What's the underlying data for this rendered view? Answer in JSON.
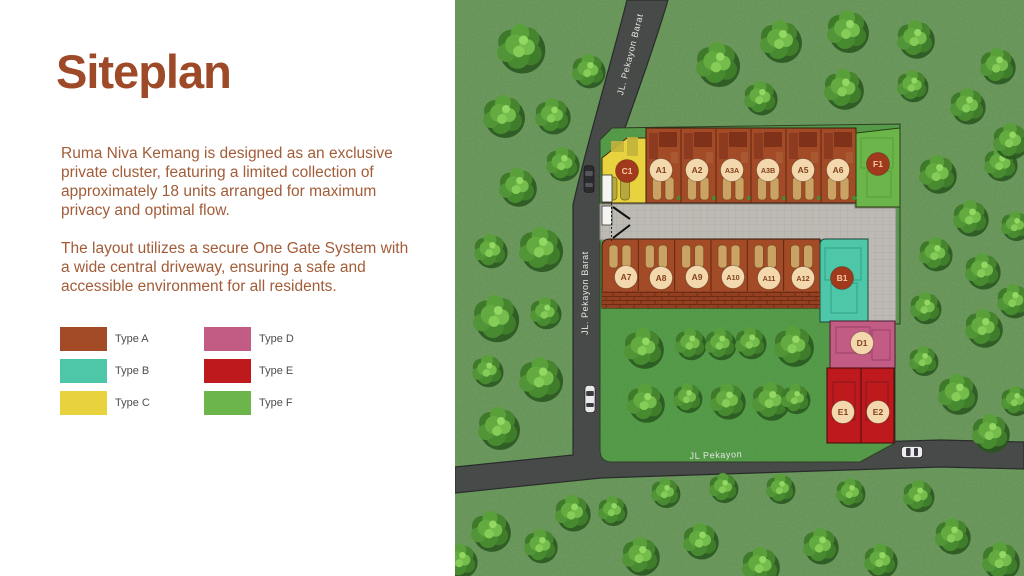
{
  "slide": {
    "title": "Siteplan",
    "paragraphs": [
      "Ruma Niva Kemang is designed as an exclusive private cluster, featuring a limited collection of approximately 18 units arranged for maximum privacy and optimal flow.",
      "The layout utilizes a secure One Gate System with a wide central driveway, ensuring a safe and accessible environment for all residents."
    ]
  },
  "legend": {
    "items": [
      {
        "label": "Type A",
        "color": "#a34a26"
      },
      {
        "label": "Type B",
        "color": "#4ec7a8"
      },
      {
        "label": "Type C",
        "color": "#e8d33f"
      },
      {
        "label": "Type D",
        "color": "#c25c84"
      },
      {
        "label": "Type E",
        "color": "#be1a1e"
      },
      {
        "label": "Type F",
        "color": "#6cb54a"
      }
    ]
  },
  "map": {
    "colors": {
      "grass_outer": "#6f9d61",
      "grass_inner": "#57a14c",
      "road": "#48484b",
      "driveway": "#bdbab4",
      "title_text": "#9e4a28",
      "body_text": "#a35c38",
      "road_label_text": "#e6e6e2"
    },
    "road_labels": [
      {
        "text": "JL. Pekayon Barat",
        "x": 633,
        "y": 55,
        "rotate": -76
      },
      {
        "text": "JL. Pekayon Barat",
        "x": 588,
        "y": 293,
        "rotate": -90
      },
      {
        "text": "JL Pekayon",
        "x": 716,
        "y": 458,
        "rotate": -2
      }
    ],
    "unit_marker_styles": {
      "light": {
        "bg": "#f2d8ac",
        "fg": "#82401e"
      },
      "dark": {
        "bg": "#a13a1c",
        "fg": "#f9c9a2"
      }
    },
    "units": [
      {
        "id": "C1",
        "x": 627,
        "y": 171,
        "style": "dark"
      },
      {
        "id": "A1",
        "x": 661,
        "y": 170,
        "style": "light"
      },
      {
        "id": "A2",
        "x": 697,
        "y": 170,
        "style": "light"
      },
      {
        "id": "A3A",
        "x": 732,
        "y": 170,
        "style": "light"
      },
      {
        "id": "A3B",
        "x": 768,
        "y": 170,
        "style": "light"
      },
      {
        "id": "A5",
        "x": 803,
        "y": 170,
        "style": "light"
      },
      {
        "id": "A6",
        "x": 838,
        "y": 170,
        "style": "light"
      },
      {
        "id": "F1",
        "x": 878,
        "y": 164,
        "style": "dark"
      },
      {
        "id": "A7",
        "x": 626,
        "y": 277,
        "style": "light"
      },
      {
        "id": "A8",
        "x": 661,
        "y": 278,
        "style": "light"
      },
      {
        "id": "A9",
        "x": 697,
        "y": 277,
        "style": "light"
      },
      {
        "id": "A10",
        "x": 733,
        "y": 277,
        "style": "light"
      },
      {
        "id": "A11",
        "x": 769,
        "y": 278,
        "style": "light"
      },
      {
        "id": "A12",
        "x": 803,
        "y": 278,
        "style": "light"
      },
      {
        "id": "B1",
        "x": 842,
        "y": 278,
        "style": "dark"
      },
      {
        "id": "D1",
        "x": 862,
        "y": 343,
        "style": "light"
      },
      {
        "id": "E1",
        "x": 843,
        "y": 412,
        "style": "light"
      },
      {
        "id": "E2",
        "x": 878,
        "y": 412,
        "style": "light"
      }
    ],
    "trees": [
      [
        520,
        47,
        1.15
      ],
      [
        588,
        70,
        0.8
      ],
      [
        503,
        115,
        1.0
      ],
      [
        552,
        115,
        0.85
      ],
      [
        562,
        163,
        0.8
      ],
      [
        517,
        186,
        0.9
      ],
      [
        490,
        250,
        0.8
      ],
      [
        540,
        248,
        1.05
      ],
      [
        495,
        317,
        1.1
      ],
      [
        545,
        312,
        0.75
      ],
      [
        487,
        370,
        0.75
      ],
      [
        540,
        378,
        1.05
      ],
      [
        498,
        427,
        1.0
      ],
      [
        717,
        63,
        1.05
      ],
      [
        780,
        40,
        1.0
      ],
      [
        760,
        97,
        0.8
      ],
      [
        847,
        30,
        1.0
      ],
      [
        915,
        38,
        0.9
      ],
      [
        997,
        65,
        0.85
      ],
      [
        843,
        88,
        0.95
      ],
      [
        912,
        85,
        0.75
      ],
      [
        967,
        105,
        0.85
      ],
      [
        937,
        173,
        0.9
      ],
      [
        1000,
        163,
        0.8
      ],
      [
        970,
        217,
        0.85
      ],
      [
        935,
        253,
        0.8
      ],
      [
        982,
        270,
        0.85
      ],
      [
        925,
        307,
        0.75
      ],
      [
        983,
        327,
        0.9
      ],
      [
        923,
        360,
        0.7
      ],
      [
        957,
        393,
        0.95
      ],
      [
        1013,
        300,
        0.8
      ],
      [
        1010,
        140,
        0.85
      ],
      [
        1015,
        225,
        0.7
      ],
      [
        990,
        432,
        0.9
      ],
      [
        1015,
        400,
        0.7
      ],
      [
        643,
        347,
        0.95
      ],
      [
        690,
        343,
        0.75
      ],
      [
        720,
        343,
        0.75
      ],
      [
        750,
        342,
        0.75
      ],
      [
        793,
        345,
        0.95
      ],
      [
        645,
        402,
        0.9
      ],
      [
        687,
        397,
        0.7
      ],
      [
        727,
        400,
        0.85
      ],
      [
        770,
        400,
        0.9
      ],
      [
        795,
        398,
        0.7
      ],
      [
        490,
        530,
        0.95
      ],
      [
        540,
        545,
        0.8
      ],
      [
        572,
        512,
        0.85
      ],
      [
        640,
        555,
        0.9
      ],
      [
        665,
        492,
        0.7
      ],
      [
        700,
        540,
        0.85
      ],
      [
        723,
        487,
        0.7
      ],
      [
        760,
        565,
        0.9
      ],
      [
        780,
        488,
        0.7
      ],
      [
        820,
        545,
        0.85
      ],
      [
        850,
        492,
        0.7
      ],
      [
        880,
        560,
        0.8
      ],
      [
        918,
        495,
        0.75
      ],
      [
        952,
        535,
        0.85
      ],
      [
        1000,
        560,
        0.9
      ],
      [
        460,
        560,
        0.8
      ],
      [
        612,
        510,
        0.7
      ]
    ],
    "cars": [
      {
        "x": 589,
        "y": 179,
        "o": "v",
        "body": "#2b2b2e"
      },
      {
        "x": 590,
        "y": 399,
        "o": "v",
        "body": "#e9e9ec"
      },
      {
        "x": 912,
        "y": 452,
        "o": "h",
        "body": "#ededf0"
      }
    ]
  }
}
